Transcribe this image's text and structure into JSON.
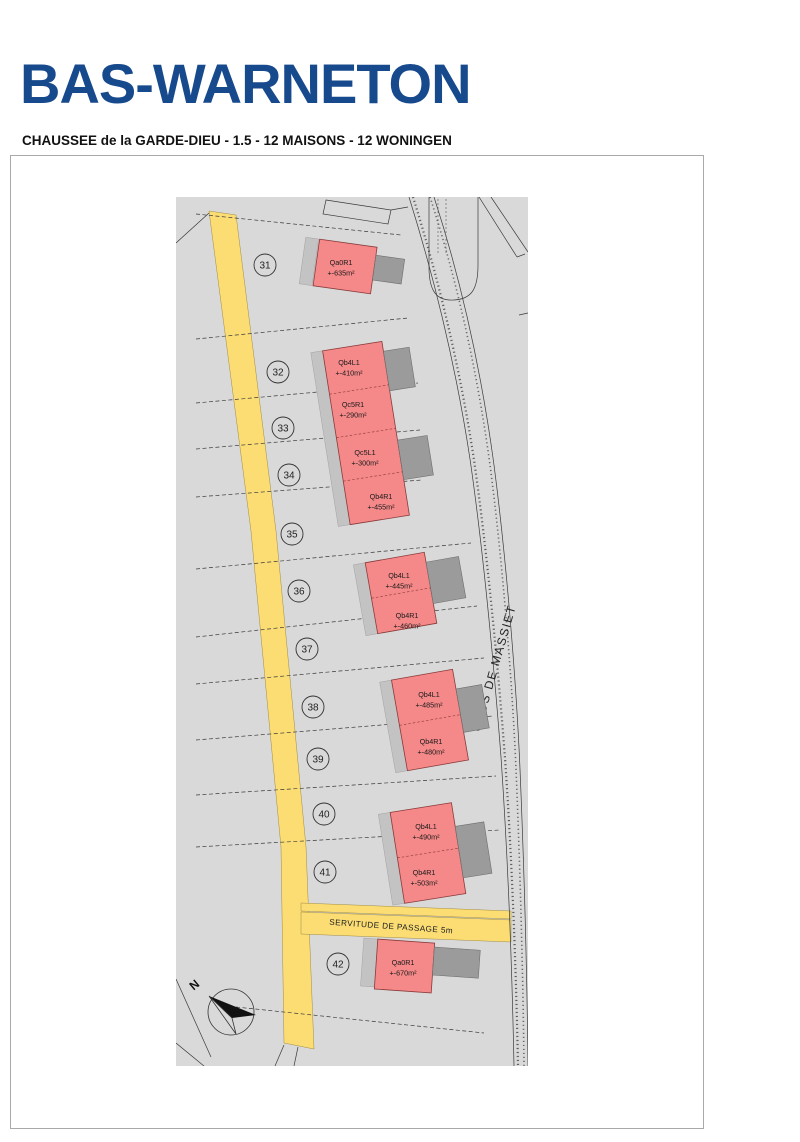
{
  "header": {
    "title": "BAS-WARNETON",
    "subtitle": "CHAUSSEE de la GARDE-DIEU - 1.5 - 12 MAISONS - 12 WONINGEN"
  },
  "map": {
    "street_label": "CLOS DE MASSIET",
    "servitude_label": "SERVITUDE DE PASSAGE 5m",
    "compass_label": "N",
    "lots": [
      "31",
      "32",
      "33",
      "34",
      "35",
      "36",
      "37",
      "38",
      "39",
      "40",
      "41",
      "42"
    ],
    "houses": [
      {
        "code": "Qa0R1",
        "area": "+-635m²"
      },
      {
        "code": "Qb4L1",
        "area": "+-410m²"
      },
      {
        "code": "Qc5R1",
        "area": "+-290m²"
      },
      {
        "code": "Qc5L1",
        "area": "+-300m²"
      },
      {
        "code": "Qb4R1",
        "area": "+-455m²"
      },
      {
        "code": "Qb4L1",
        "area": "+-445m²"
      },
      {
        "code": "Qb4R1",
        "area": "+-460m²"
      },
      {
        "code": "Qb4L1",
        "area": "+-485m²"
      },
      {
        "code": "Qb4R1",
        "area": "+-480m²"
      },
      {
        "code": "Qb4L1",
        "area": "+-490m²"
      },
      {
        "code": "Qb4R1",
        "area": "+-503m²"
      },
      {
        "code": "Qa0R1",
        "area": "+-670m²"
      }
    ],
    "colors": {
      "title_blue": "#17498d",
      "map_bg": "#d9d9d9",
      "house_red": "#f58888",
      "road_yellow": "#fbdd74",
      "garage_gray": "#9b9b9b",
      "side_gray": "#c3c3c3"
    }
  }
}
